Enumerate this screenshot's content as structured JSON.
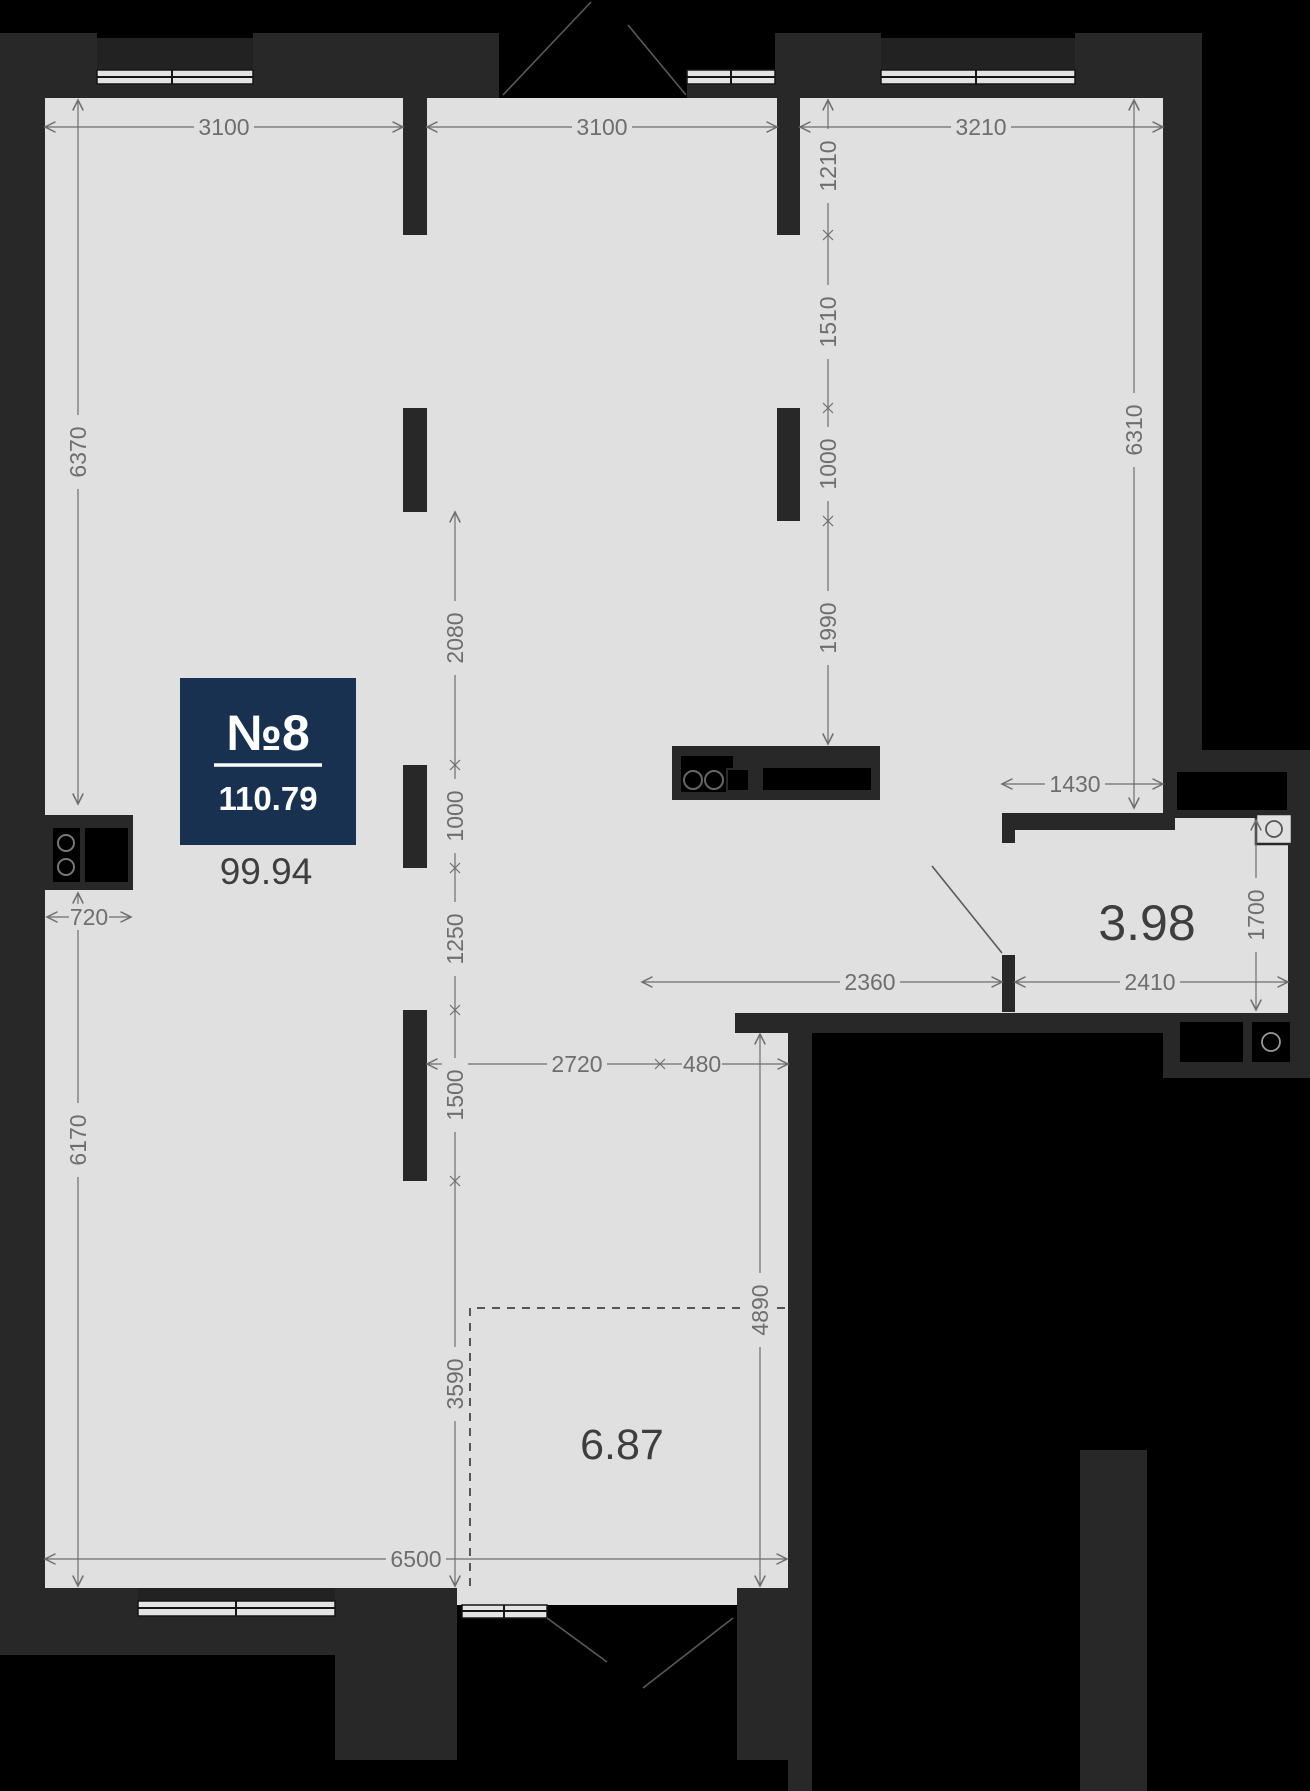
{
  "plan": {
    "badge": {
      "unit_label": "№8",
      "area_value": "110.79"
    },
    "room_areas": {
      "main": "99.94",
      "bathroom": "3.98",
      "loggia": "6.87"
    },
    "dimensions": {
      "top_room1": "3100",
      "top_room2": "3100",
      "top_room3": "3210",
      "left_upper": "6370",
      "left_lower": "6170",
      "left_niche": "720",
      "mid_seg1": "2080",
      "mid_seg2": "1000",
      "mid_seg3": "1250",
      "mid_seg4": "1500",
      "mid_seg5": "3590",
      "right_seg1": "1210",
      "right_seg2": "1510",
      "right_seg3": "1000",
      "right_seg4": "1990",
      "right_height": "6310",
      "bath_top": "1430",
      "bath_height": "1700",
      "hall_left": "2360",
      "bath_width": "2410",
      "lower_left": "2720",
      "lower_gap": "480",
      "lower_height": "4890",
      "bottom_width": "6500"
    },
    "colors": {
      "background": "#000000",
      "wall": "#282828",
      "floor": "#e0e0e0",
      "badge": "#183150",
      "dim": "#6e6e6e"
    }
  }
}
